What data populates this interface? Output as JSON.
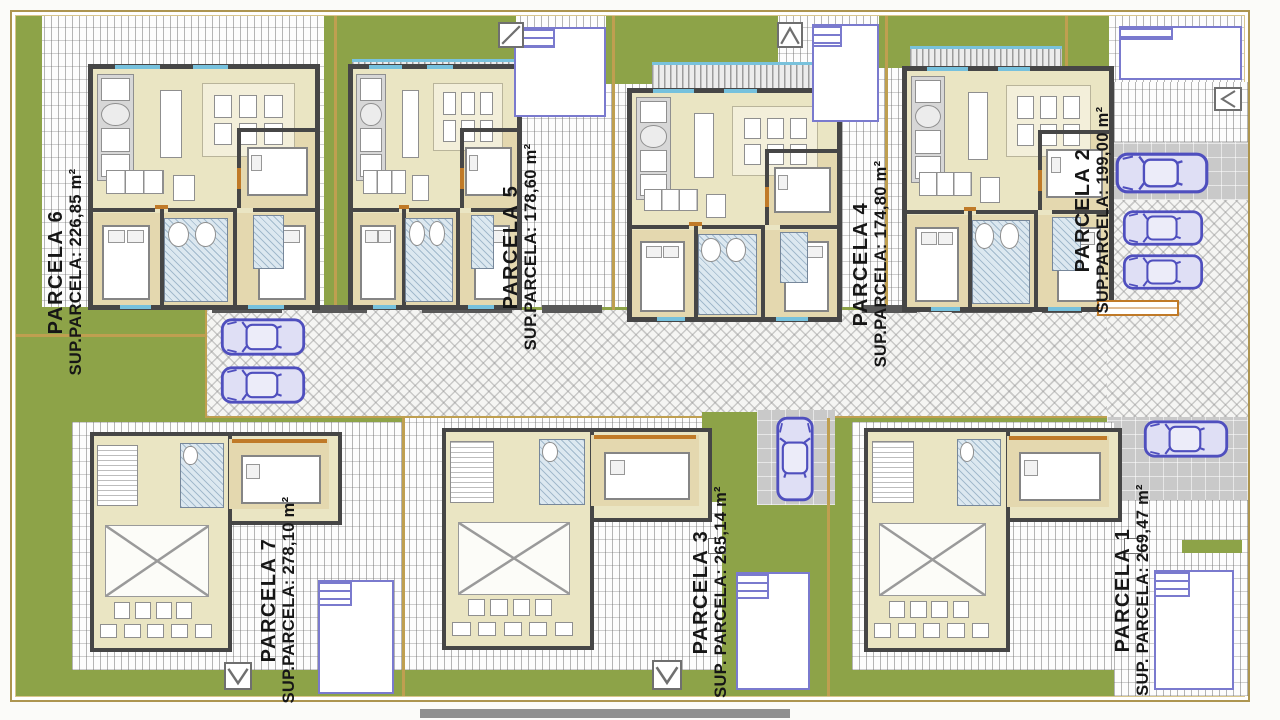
{
  "drawing": {
    "kind": "residential site plan",
    "colors": {
      "lawn": "#8da348",
      "boundary": "#bf9f50",
      "walls": "#464646",
      "interior": "#eae5c3",
      "pool_edge": "#7a7ace",
      "car_outline": "#4f4fbe",
      "window_sill": "#76c1dd",
      "door_accent": "#c07a28"
    }
  },
  "parcels": [
    {
      "name": "PARCELA 1",
      "sup": "SUP. PARCELA: 269,47 m²"
    },
    {
      "name": "PARCELA 2",
      "sup": "SUP.PARCELA: 199,00 m²"
    },
    {
      "name": "PARCELA 3",
      "sup": "SUP. PARCELA: 265,14 m²"
    },
    {
      "name": "PARCELA 4",
      "sup": "SUP.PARCELA: 174,80 m²"
    },
    {
      "name": "PARCELA 5",
      "sup": "SUP.PARCELA: 178,60 m²"
    },
    {
      "name": "PARCELA 6",
      "sup": "SUP.PARCELA: 226,85 m²"
    },
    {
      "name": "PARCELA 7",
      "sup": "SUP.PARCELA: 278,10 m²"
    }
  ]
}
